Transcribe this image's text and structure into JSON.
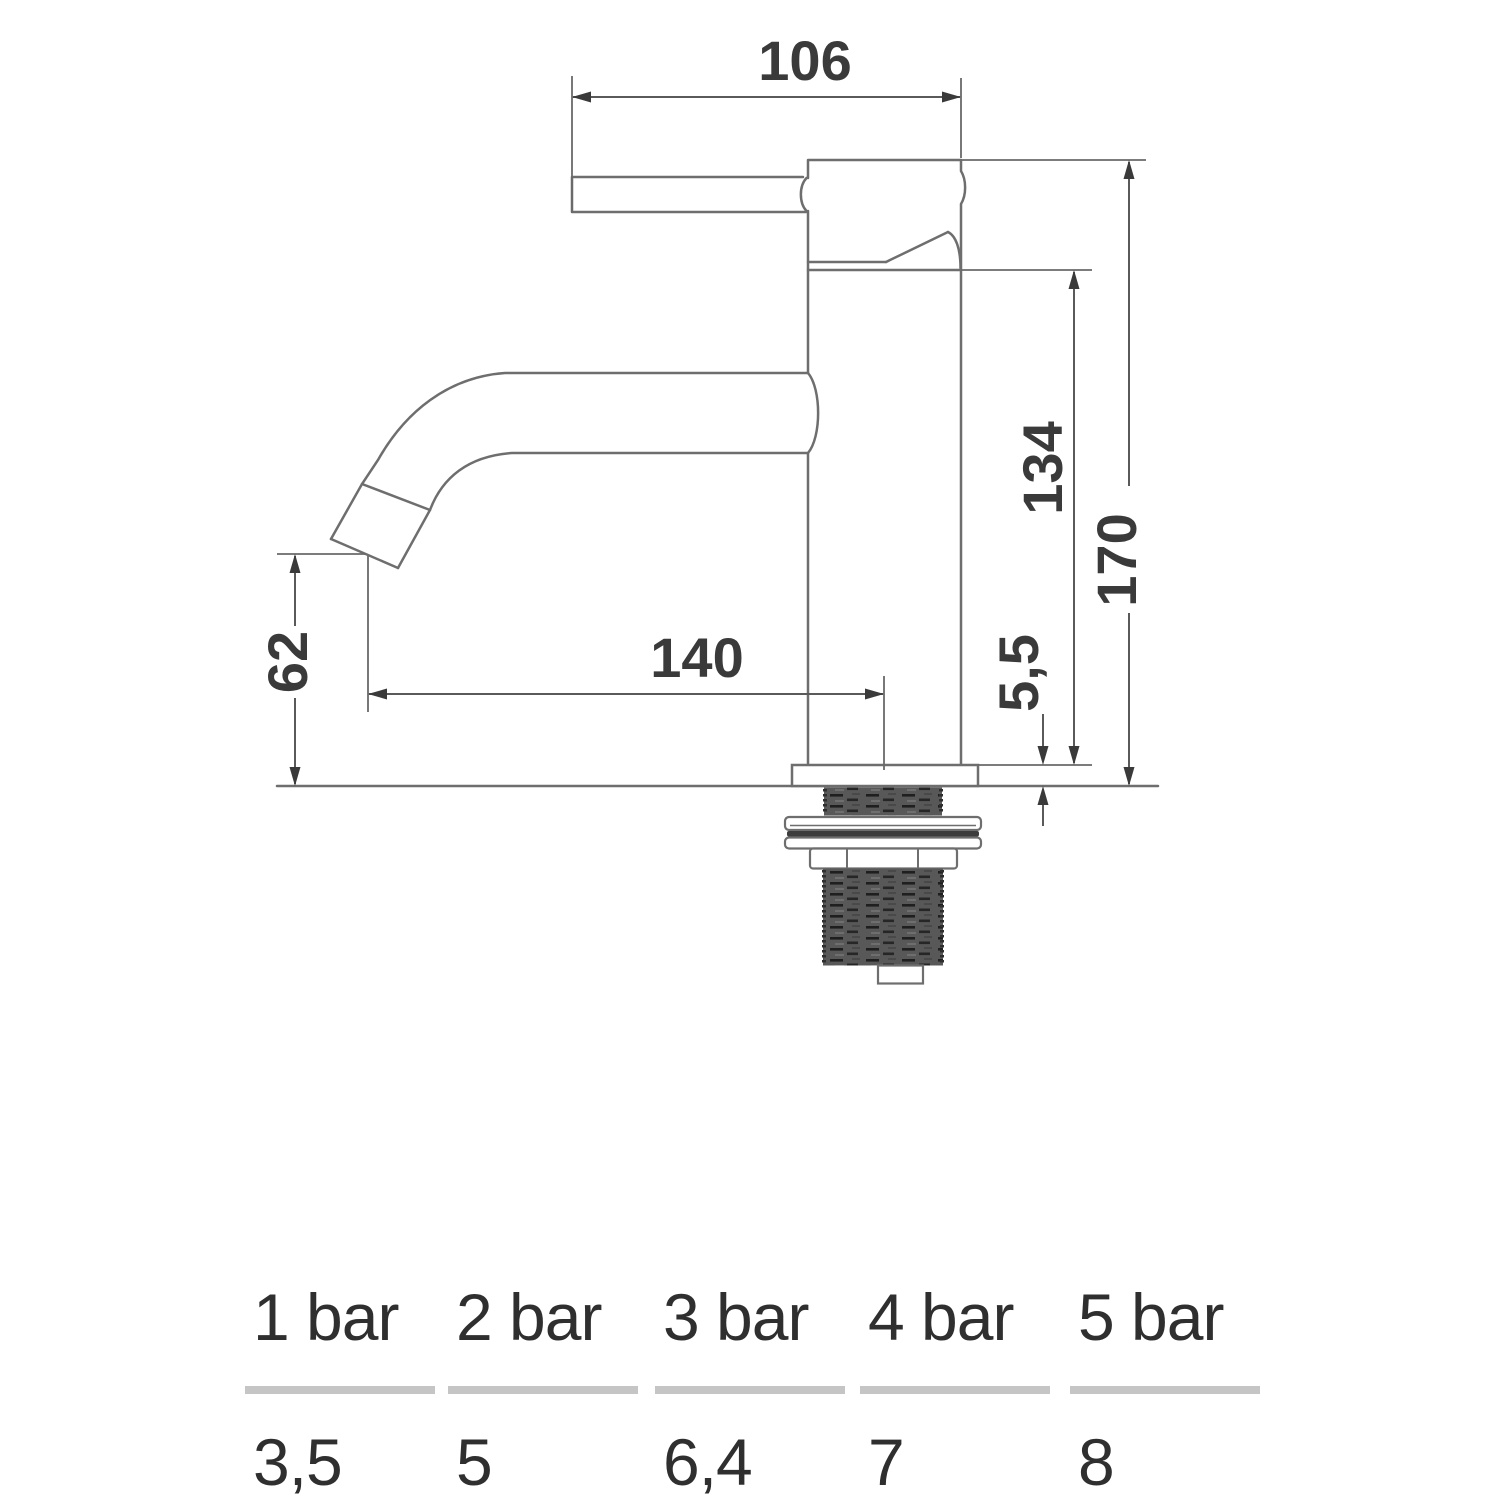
{
  "drawing": {
    "type": "technical-drawing",
    "subject": "single-lever basin tap, side elevation with installation dimensions (mm)",
    "dimension_labels": {
      "handle_body_width": "106",
      "body_height_above_deck": "134",
      "total_height": "170",
      "spout_outlet_height": "62",
      "spout_projection": "140",
      "deck_plate_thickness": "5,5"
    },
    "colors": {
      "outline": "#6e6e6e",
      "dimension_line": "#5a5a5a",
      "arrow_and_text": "#3a3a3a",
      "thread_fill": "#585858",
      "background": "#ffffff"
    }
  },
  "flow_table": {
    "columns": [
      {
        "pressure": "1 bar",
        "flow": "3,5"
      },
      {
        "pressure": "2 bar",
        "flow": "5"
      },
      {
        "pressure": "3 bar",
        "flow": "6,4"
      },
      {
        "pressure": "4 bar",
        "flow": "7"
      },
      {
        "pressure": "5 bar",
        "flow": "8"
      }
    ],
    "divider_color": "#c5c5c5"
  },
  "chart_data": {
    "type": "table",
    "categories": [
      "1 bar",
      "2 bar",
      "3 bar",
      "4 bar",
      "5 bar"
    ],
    "values": [
      3.5,
      5,
      6.4,
      7,
      8
    ]
  }
}
